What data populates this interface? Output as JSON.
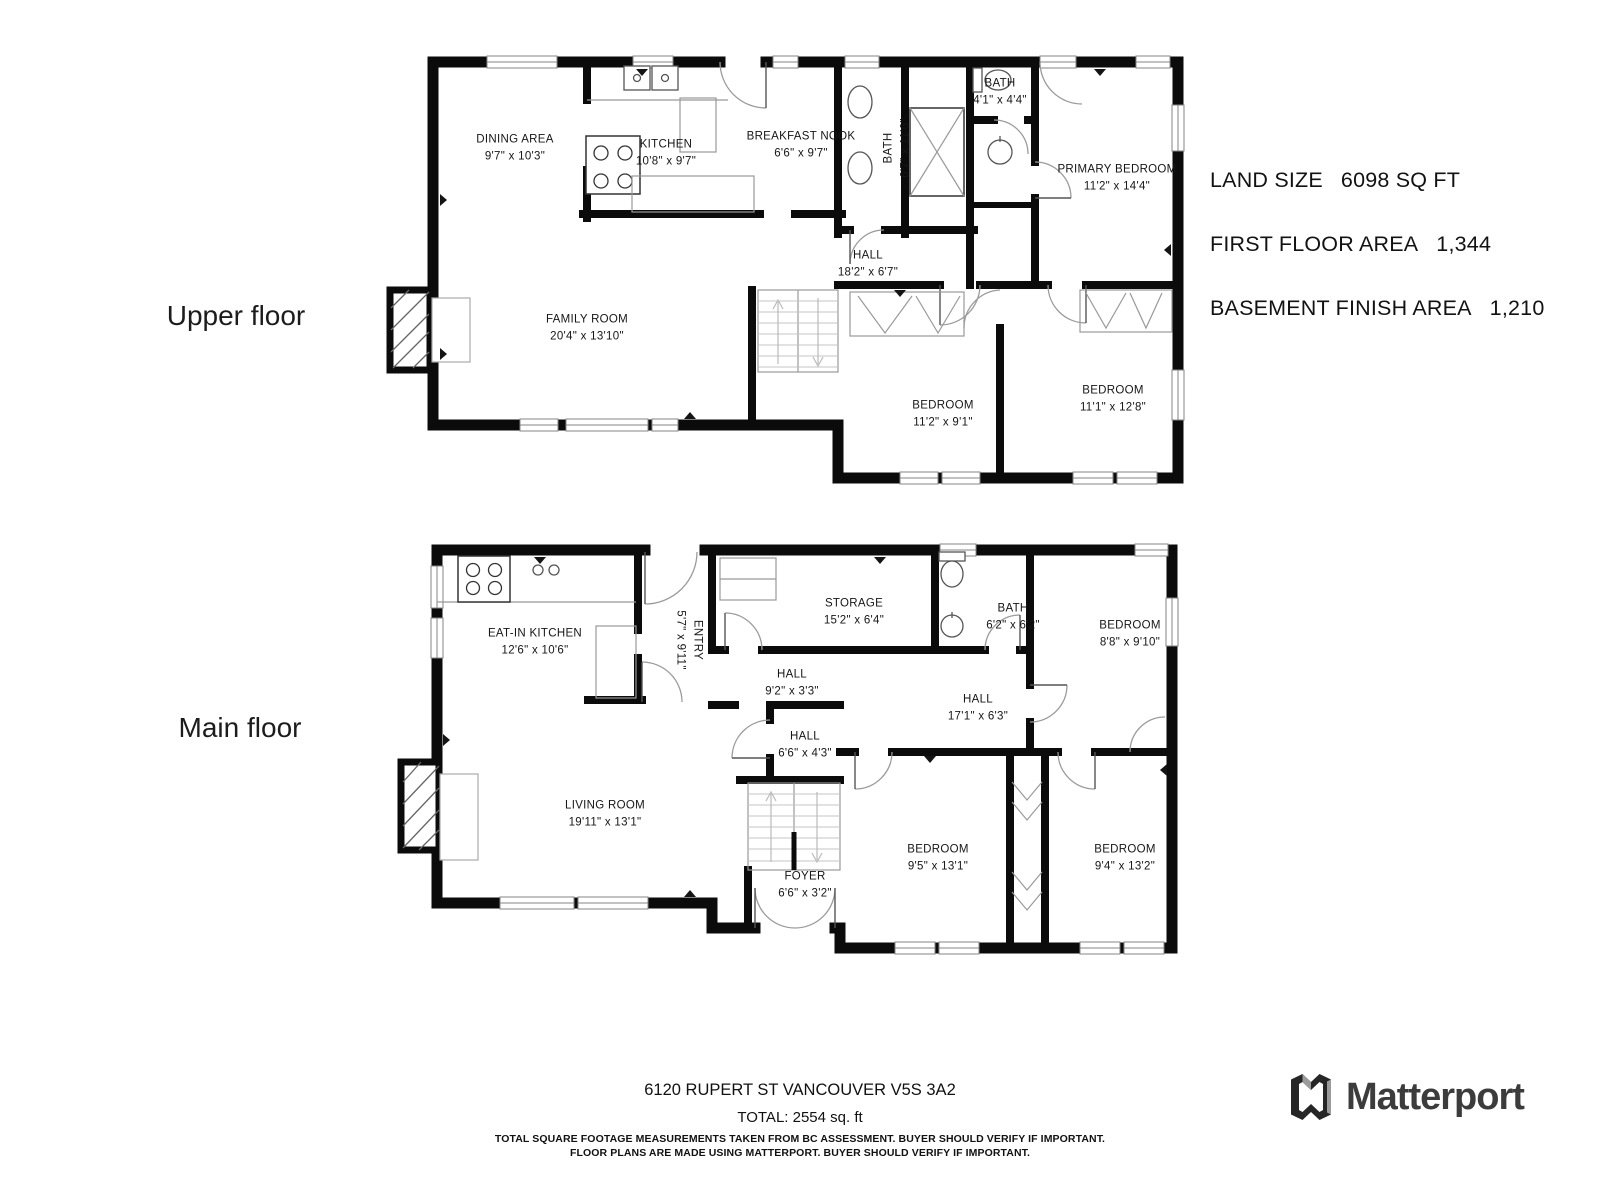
{
  "floors": [
    {
      "id": "upper",
      "label": "Upper floor",
      "rooms": [
        {
          "id": "dining",
          "name": "DINING AREA",
          "dims": "9'7\" x 10'3\""
        },
        {
          "id": "kitchen",
          "name": "KITCHEN",
          "dims": "10'8\" x 9'7\""
        },
        {
          "id": "nook",
          "name": "BREAKFAST NOOK",
          "dims": "6'6\" x 9'7\""
        },
        {
          "id": "bath_main",
          "name": "BATH",
          "dims": "6'7\" x 11'6\""
        },
        {
          "id": "bath_small",
          "name": "BATH",
          "dims": "4'1\" x 4'4\""
        },
        {
          "id": "primary",
          "name": "PRIMARY BEDROOM",
          "dims": "11'2\" x 14'4\""
        },
        {
          "id": "hall",
          "name": "HALL",
          "dims": "18'2\" x 6'7\""
        },
        {
          "id": "family",
          "name": "FAMILY ROOM",
          "dims": "20'4\" x 13'10\""
        },
        {
          "id": "bedroom_a",
          "name": "BEDROOM",
          "dims": "11'2\" x 9'1\""
        },
        {
          "id": "bedroom_b",
          "name": "BEDROOM",
          "dims": "11'1\" x 12'8\""
        }
      ]
    },
    {
      "id": "main",
      "label": "Main floor",
      "rooms": [
        {
          "id": "kitchen",
          "name": "EAT-IN KITCHEN",
          "dims": "12'6\" x 10'6\""
        },
        {
          "id": "entry",
          "name": "ENTRY",
          "dims": "5'7\" x 9'11\""
        },
        {
          "id": "storage",
          "name": "STORAGE",
          "dims": "15'2\" x 6'4\""
        },
        {
          "id": "bath",
          "name": "BATH",
          "dims": "6'2\" x 6'2\""
        },
        {
          "id": "bedroom_top",
          "name": "BEDROOM",
          "dims": "8'8\" x 9'10\""
        },
        {
          "id": "hall_a",
          "name": "HALL",
          "dims": "9'2\" x 3'3\""
        },
        {
          "id": "hall_b",
          "name": "HALL",
          "dims": "17'1\" x 6'3\""
        },
        {
          "id": "hall_c",
          "name": "HALL",
          "dims": "6'6\" x 4'3\""
        },
        {
          "id": "living",
          "name": "LIVING ROOM",
          "dims": "19'11\" x 13'1\""
        },
        {
          "id": "foyer",
          "name": "FOYER",
          "dims": "6'6\" x 3'2\""
        },
        {
          "id": "bedroom_left",
          "name": "BEDROOM",
          "dims": "9'5\" x 13'1\""
        },
        {
          "id": "bedroom_right",
          "name": "BEDROOM",
          "dims": "9'4\" x 13'2\""
        }
      ]
    }
  ],
  "stats": [
    {
      "label": "LAND SIZE",
      "value": "6098 SQ FT"
    },
    {
      "label": "FIRST FLOOR AREA",
      "value": "1,344"
    },
    {
      "label": "BASEMENT FINISH AREA",
      "value": "1,210"
    }
  ],
  "footer": {
    "address": "6120 RUPERT ST VANCOUVER V5S 3A2",
    "total": "TOTAL: 2554 sq. ft",
    "disclaimer_line1": "TOTAL SQUARE FOOTAGE MEASUREMENTS TAKEN FROM BC ASSESSMENT. BUYER SHOULD VERIFY IF IMPORTANT.",
    "disclaimer_line2": "FLOOR PLANS ARE MADE USING MATTERPORT. BUYER SHOULD VERIFY IF IMPORTANT."
  },
  "branding": {
    "logo_text": "Matterport"
  }
}
